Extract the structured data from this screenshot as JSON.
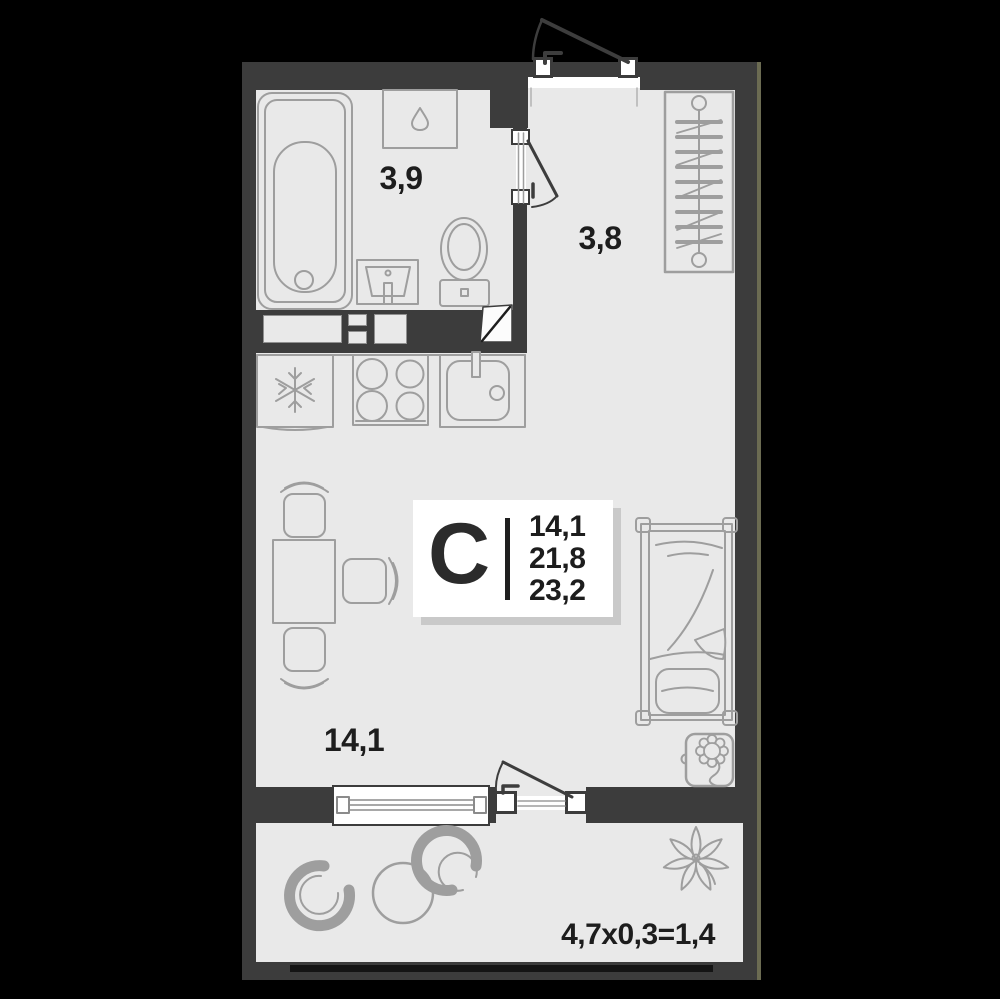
{
  "unit_card": {
    "type_letter": "С",
    "areas": [
      "14,1",
      "21,8",
      "23,2"
    ]
  },
  "rooms": [
    {
      "name": "bathroom",
      "area_label": "3,9"
    },
    {
      "name": "hallway",
      "area_label": "3,8"
    },
    {
      "name": "living-room",
      "area_label": "14,1"
    },
    {
      "name": "balcony",
      "area_label": "4,7x0,3=1,4"
    }
  ],
  "icons": {
    "snowflake-icon": "snowflake on fridge",
    "droplet-icon": "water drop on washing machine",
    "flower-icon": "flower in bedside plant pot",
    "balcony-plant-icon": "flower on balcony",
    "hangers-icon": "clothes hangers in wardrobe"
  },
  "colors": {
    "background": "#000000",
    "wall": "#3c3c3c",
    "floor": "#e9e9e9",
    "furniture_stroke": "#9e9e9e",
    "text": "#1d1d1d",
    "card_background": "#ffffff",
    "card_shadow": "#c9c9c9",
    "edge_accent": "#6b6b52"
  }
}
